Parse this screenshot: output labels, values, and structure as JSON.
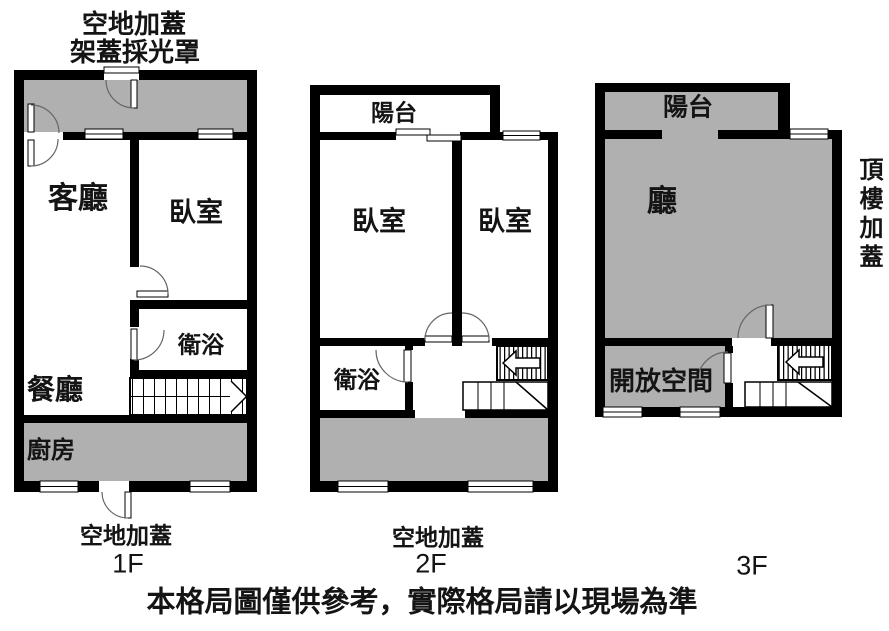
{
  "colors": {
    "wall": "#000000",
    "addition_fill": "#b0b0b0",
    "background": "#ffffff",
    "door_arc": "#666666"
  },
  "header_note": {
    "line1": "空地加蓋",
    "line2": "架蓋採光罩"
  },
  "floors": [
    {
      "label": "1F",
      "bottom_note": "空地加蓋",
      "rooms": {
        "living": "客廳",
        "bedroom": "臥室",
        "bath": "衛浴",
        "dining": "餐廳",
        "kitchen": "廚房"
      }
    },
    {
      "label": "2F",
      "bottom_note": "空地加蓋",
      "rooms": {
        "balcony": "陽台",
        "bedroom_left": "臥室",
        "bedroom_right": "臥室",
        "bath": "衛浴"
      }
    },
    {
      "label": "3F",
      "side_note": "頂樓加蓋",
      "rooms": {
        "balcony": "陽台",
        "hall": "廳",
        "open_space": "開放空間"
      }
    }
  ],
  "disclaimer": "本格局圖僅供參考，實際格局請以現場為準"
}
